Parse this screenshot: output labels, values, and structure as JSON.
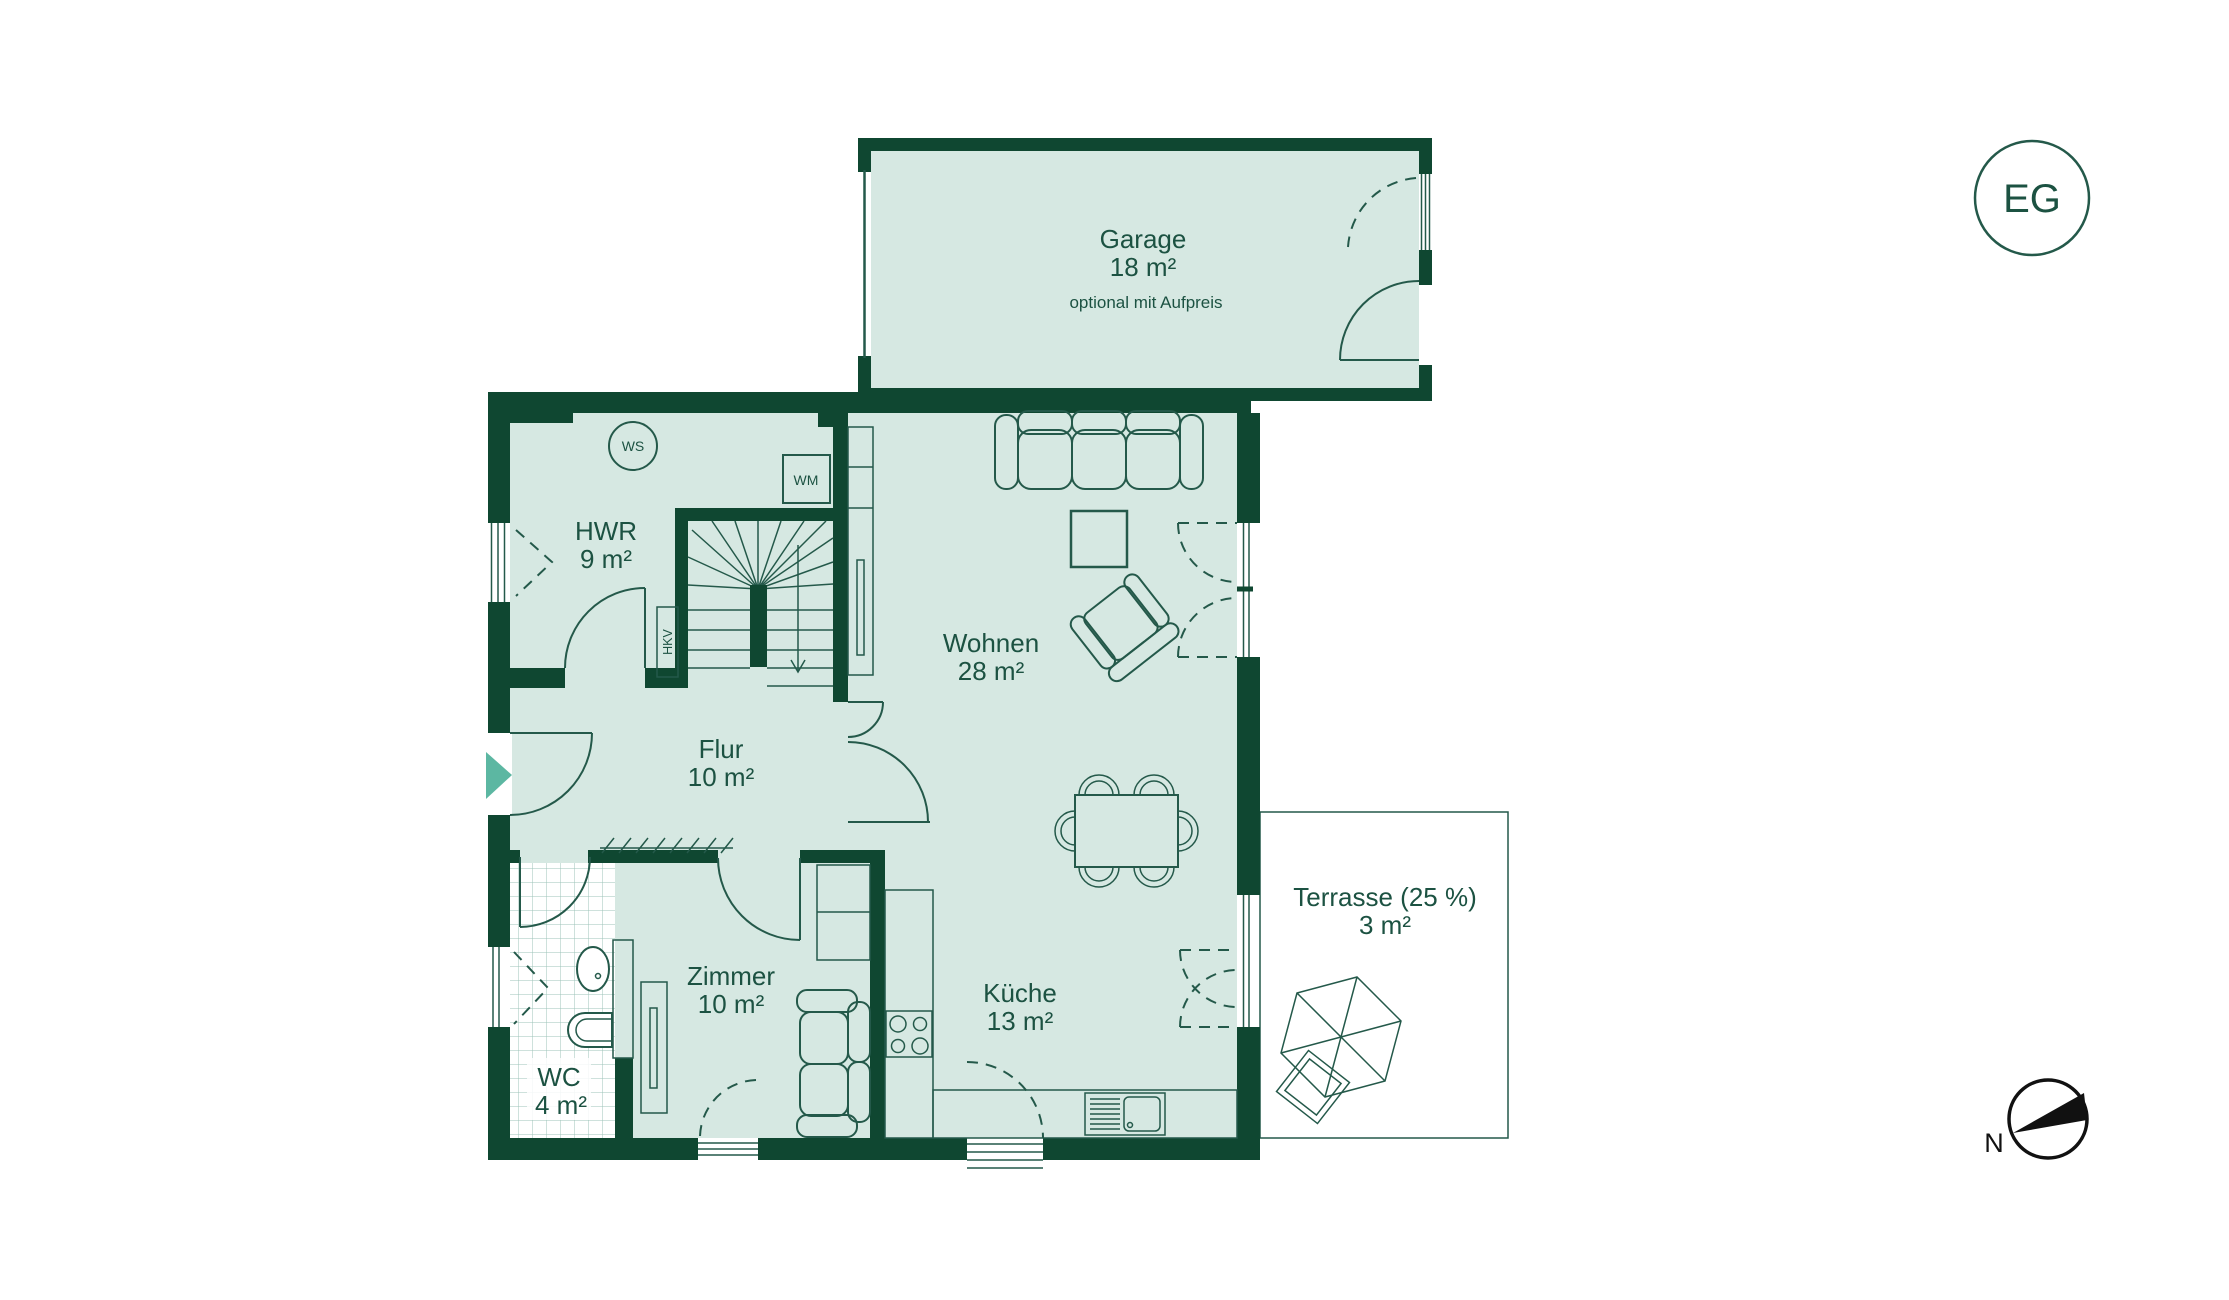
{
  "floor_badge": "EG",
  "compass_label": "N",
  "rooms": {
    "garage": {
      "name": "Garage",
      "area": "18 m²",
      "note": "optional mit Aufpreis"
    },
    "hwr": {
      "name": "HWR",
      "area": "9 m²"
    },
    "wohnen": {
      "name": "Wohnen",
      "area": "28 m²"
    },
    "flur": {
      "name": "Flur",
      "area": "10 m²"
    },
    "zimmer": {
      "name": "Zimmer",
      "area": "10 m²"
    },
    "wc": {
      "name": "WC",
      "area": "4 m²"
    },
    "kueche": {
      "name": "Küche",
      "area": "13 m²"
    },
    "terrasse": {
      "name": "Terrasse (25 %)",
      "area": "3 m²"
    }
  },
  "labels": {
    "ws": "WS",
    "wm": "WM",
    "hkv": "HKV"
  },
  "colors": {
    "wall": "#0f4731",
    "room_fill": "#d6e8e2",
    "text": "#1c5242",
    "line": "#24594a",
    "accent": "#5cb7a2",
    "tile": "#9cc3b8",
    "compass": "#111111"
  }
}
